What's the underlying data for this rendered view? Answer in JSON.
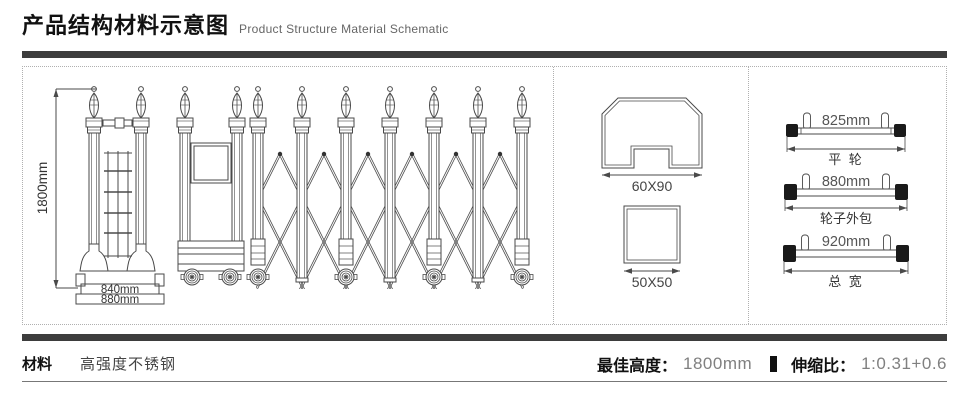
{
  "header": {
    "title_cn": "产品结构材料示意图",
    "title_en": "Product Structure Material Schematic"
  },
  "gate_drawing": {
    "height_label": "1800mm",
    "inner_width_label": "840mm",
    "outer_width_label": "880mm"
  },
  "profiles": {
    "rail_section_label": "60X90",
    "post_section_label": "50X50"
  },
  "wheel_specs": [
    {
      "value": "825mm",
      "label": "平 轮"
    },
    {
      "value": "880mm",
      "label": "轮子外包"
    },
    {
      "value": "920mm",
      "label": "总 宽"
    }
  ],
  "footer": {
    "material_label": "材料",
    "material_value": "高强度不锈钢",
    "best_height_label": "最佳高度：",
    "best_height_value": "1800mm",
    "ratio_label": "伸缩比：",
    "ratio_value": "1:0.31+0.6"
  },
  "colors": {
    "line": "#4a4a4a",
    "bar": "#3d3d3d",
    "muted_text": "#808080",
    "text": "#111111"
  }
}
